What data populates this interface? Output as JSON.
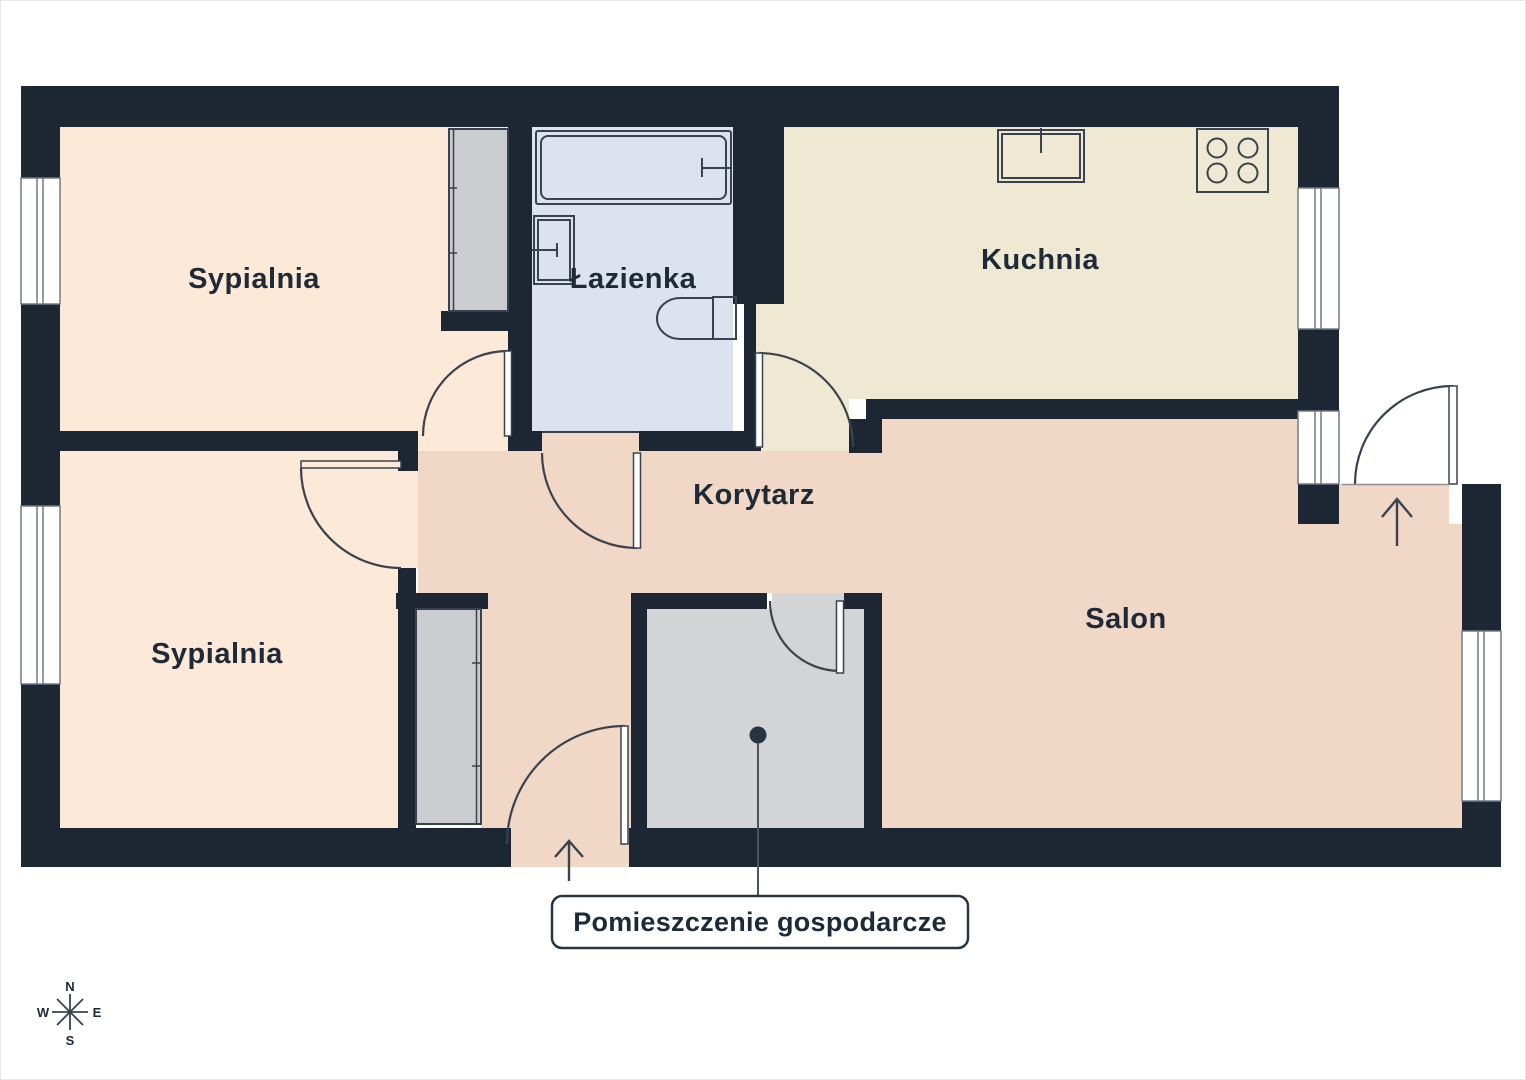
{
  "plan": {
    "rooms": {
      "bedroom_top": {
        "label": "Sypialnia"
      },
      "bedroom_bottom": {
        "label": "Sypialnia"
      },
      "bathroom": {
        "label": "Łazienka"
      },
      "kitchen": {
        "label": "Kuchnia"
      },
      "corridor": {
        "label": "Korytarz"
      },
      "living_room": {
        "label": "Salon"
      },
      "utility": {
        "label": "Pomieszczenie gospodarcze"
      }
    },
    "compass": {
      "north": "N",
      "south": "S",
      "east": "E",
      "west": "W"
    },
    "palette": {
      "wall": "#1C2733",
      "bedroom_fill": "#FCE9D8",
      "bathroom_fill": "#DCE2EE",
      "kitchen_fill": "#EFE9D3",
      "corridor_fill": "#F1D7C6",
      "utility_fill": "#D3D4D6",
      "wardrobe_fill": "#CBCDD0",
      "outline": "#39434F",
      "window_frame": "#707888",
      "text": "#1E2A38"
    }
  }
}
